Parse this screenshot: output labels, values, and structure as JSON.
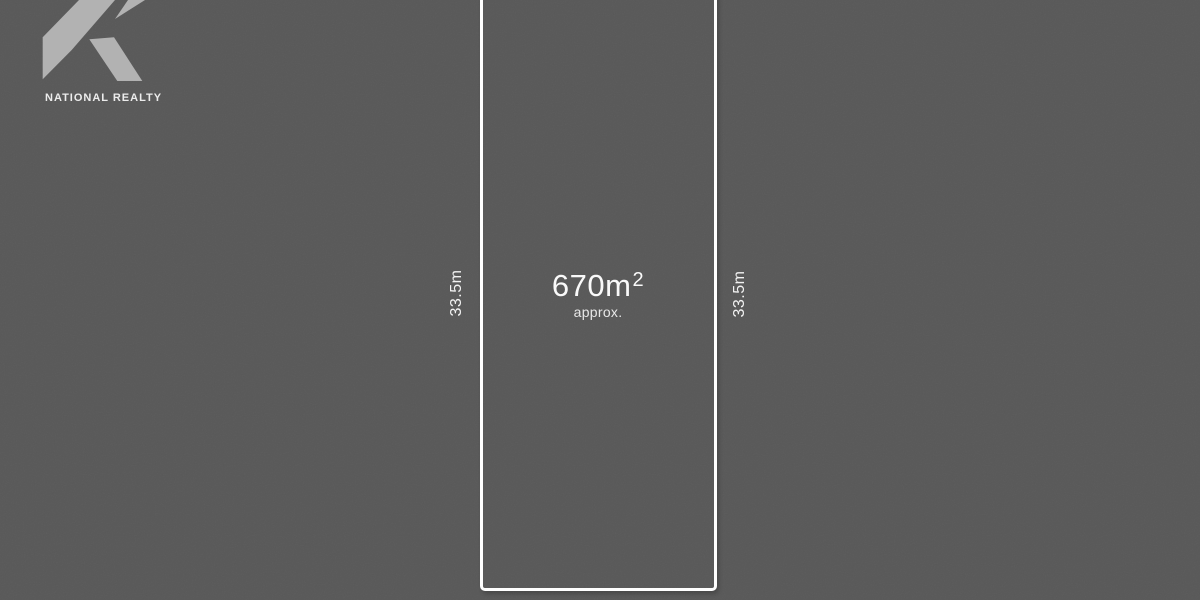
{
  "background_color": "#585858",
  "logo": {
    "brand": "NATIONAL REALTY",
    "mark_color": "#b2b2b2",
    "text_color": "#ececec",
    "mark_description": "angular-r-monogram"
  },
  "lot": {
    "border_color": "#ffffff",
    "area_value": "670m",
    "area_sup": "2",
    "area_approx": "approx.",
    "dimensions": {
      "left_side": "33.5m",
      "right_side": "33.5m"
    }
  }
}
